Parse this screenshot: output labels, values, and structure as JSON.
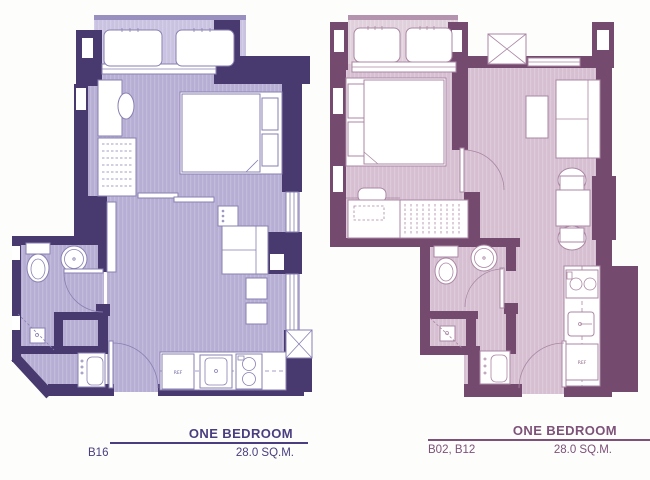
{
  "page": {
    "background_color": "#fdfdfc"
  },
  "units": [
    {
      "id": "left",
      "name": "ONE BEDROOM",
      "unit_numbers": "B16",
      "area": "28.0 SQ.M.",
      "accent_color": "#4a3d80",
      "wall_color": "#483a6e",
      "floor_color": "#b7afd3",
      "balcony_color": "#c9c3e0",
      "labels": {
        "refrigerator": "REF"
      }
    },
    {
      "id": "right",
      "name": "ONE BEDROOM",
      "unit_numbers": "B02, B12",
      "area": "28.0 SQ.M.",
      "accent_color": "#7e5178",
      "wall_color": "#744b6e",
      "floor_color": "#d5bfd1",
      "balcony_color": "#dfd0db",
      "labels": {
        "refrigerator": "REF"
      }
    }
  ]
}
